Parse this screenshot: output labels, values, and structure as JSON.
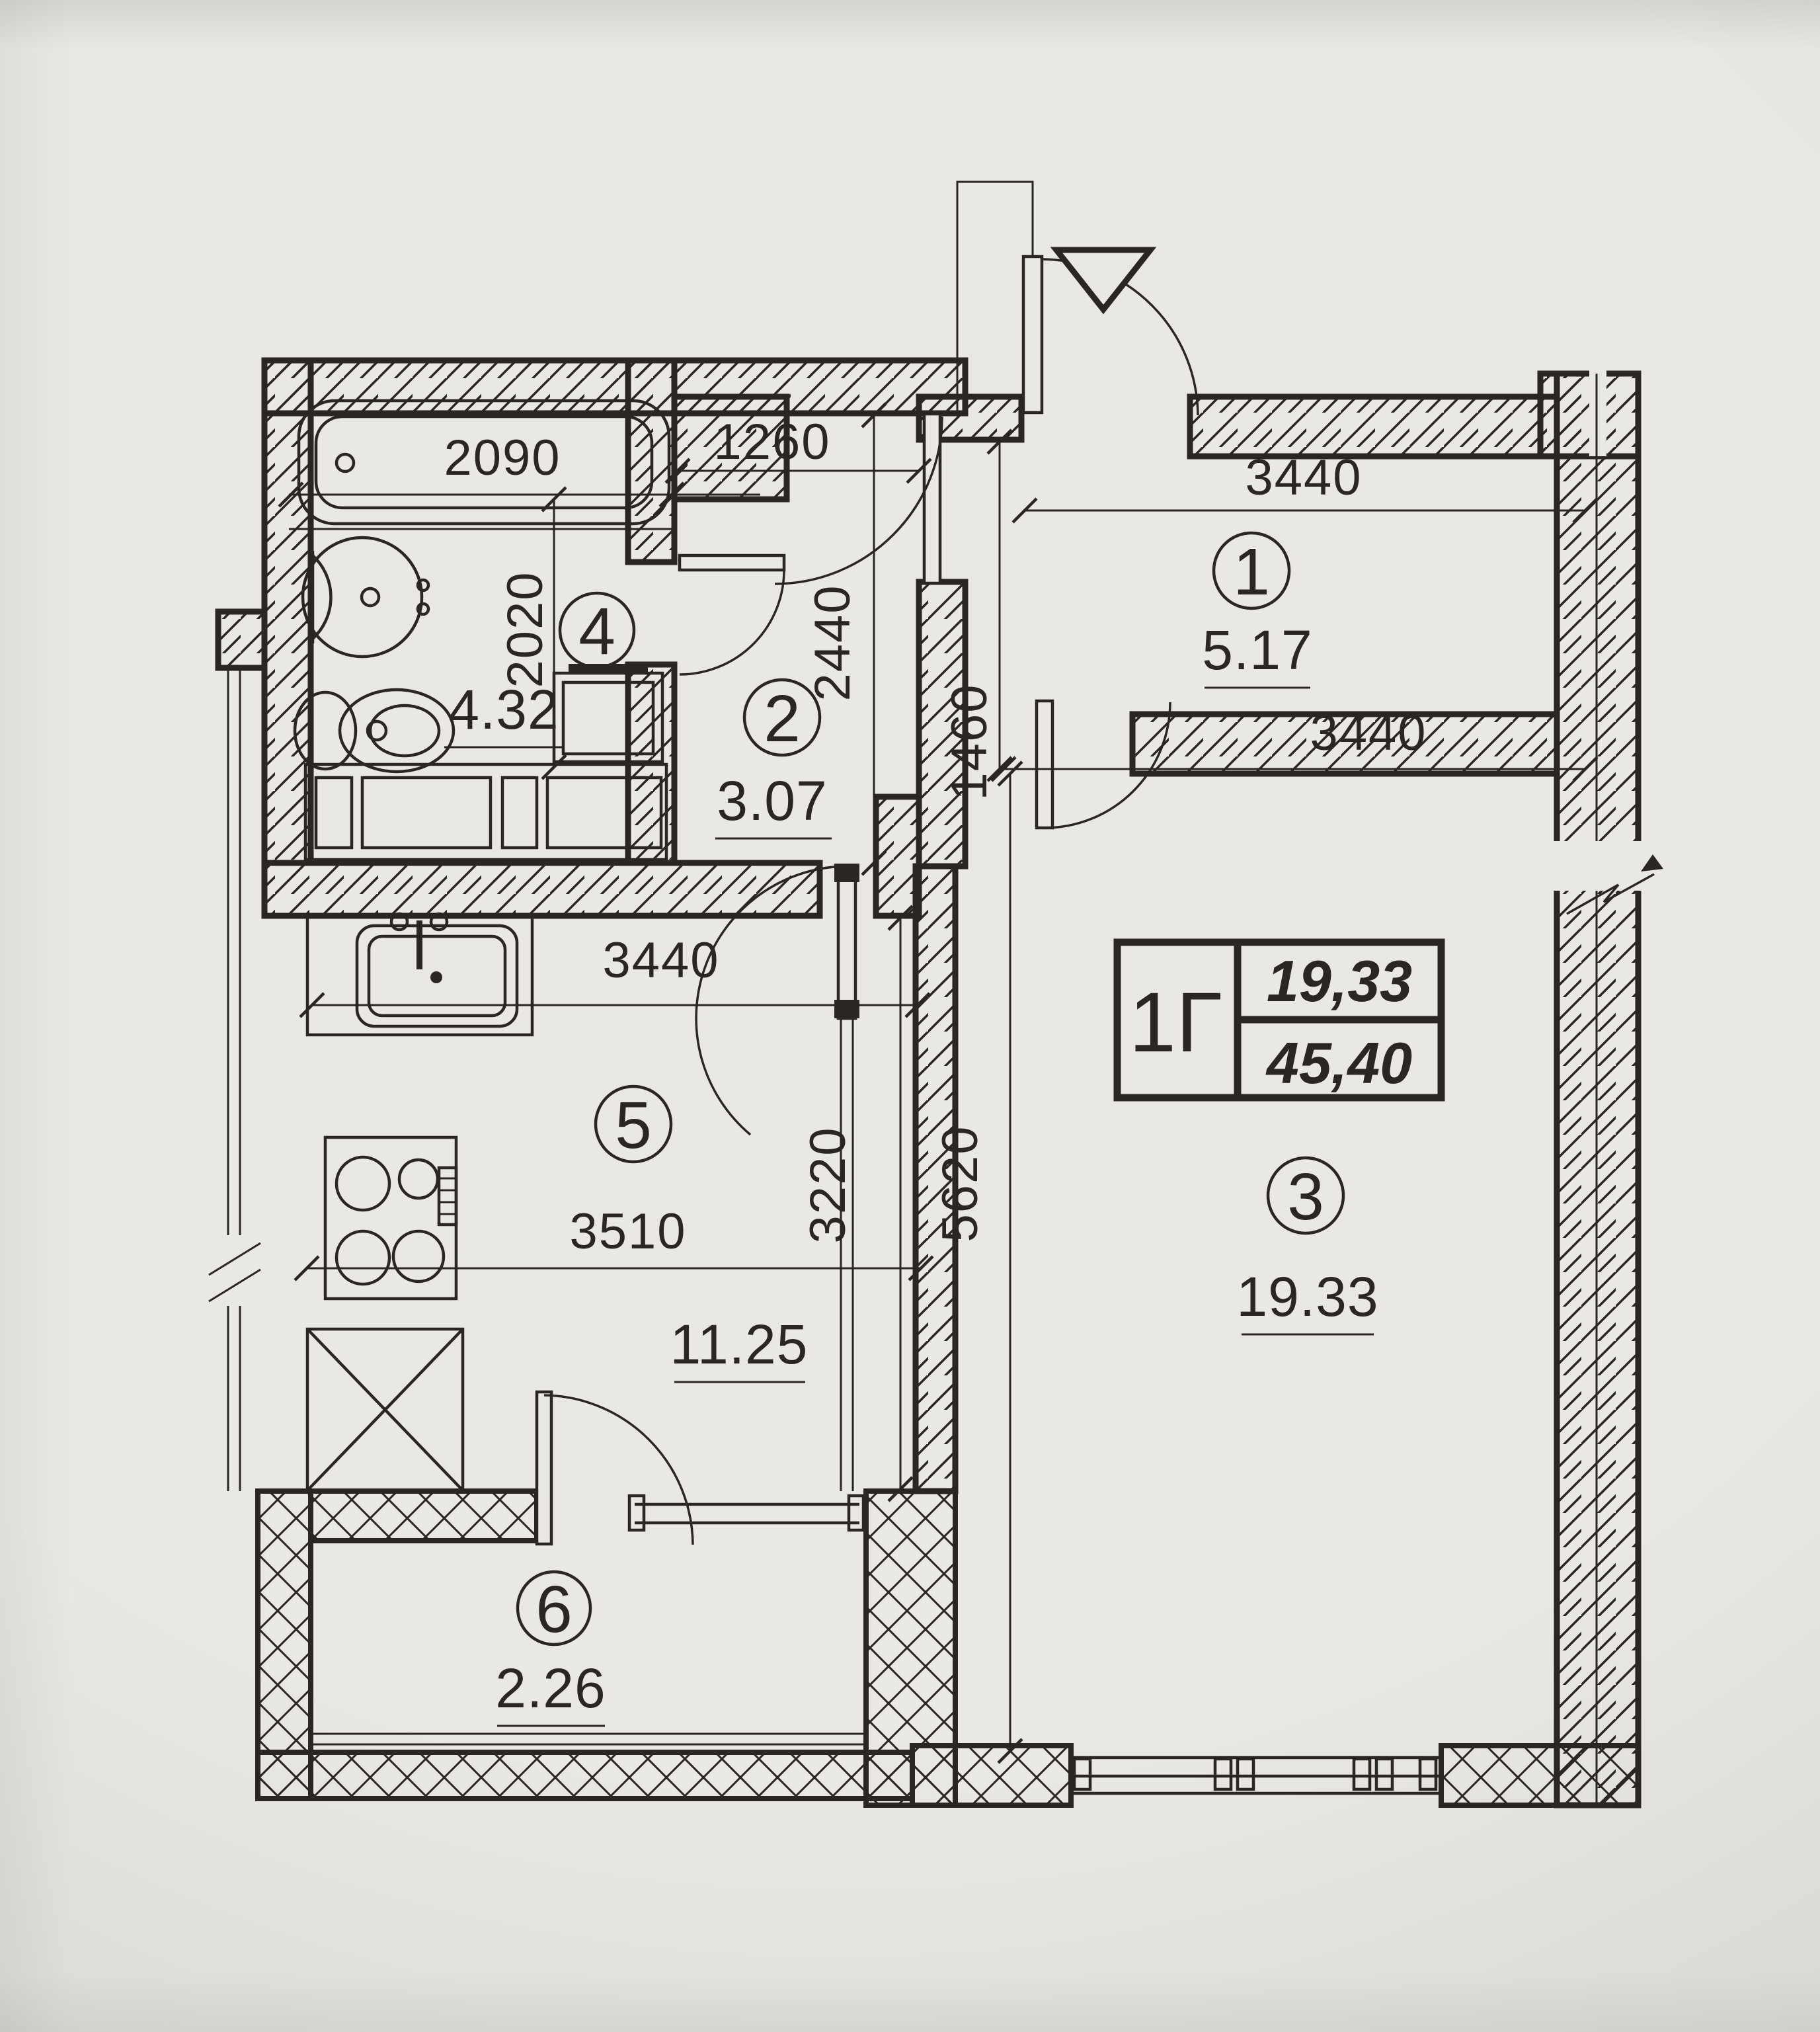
{
  "colors": {
    "paper": "#eae8e3",
    "ink": "#2b2621"
  },
  "title_block": {
    "code": "1Г",
    "upper_value": "19,33",
    "lower_value": "45,40"
  },
  "rooms": [
    {
      "number": "1",
      "area": "5.17"
    },
    {
      "number": "2",
      "area": "3.07"
    },
    {
      "number": "3",
      "area": "19.33"
    },
    {
      "number": "4",
      "area": "4.32"
    },
    {
      "number": "5",
      "area": "11.25"
    },
    {
      "number": "6",
      "area": "2.26"
    }
  ],
  "dimensions": {
    "bathtub_width": "2090",
    "bathroom_depth": "2020",
    "room2_width": "1260",
    "room2_depth": "2440",
    "room1_width": "3440",
    "corridor_width": "1460",
    "room3_width": "3440",
    "room3_depth": "5620",
    "kitchen_width": "3440",
    "kitchen_inner_width": "3510",
    "kitchen_depth": "3220"
  }
}
